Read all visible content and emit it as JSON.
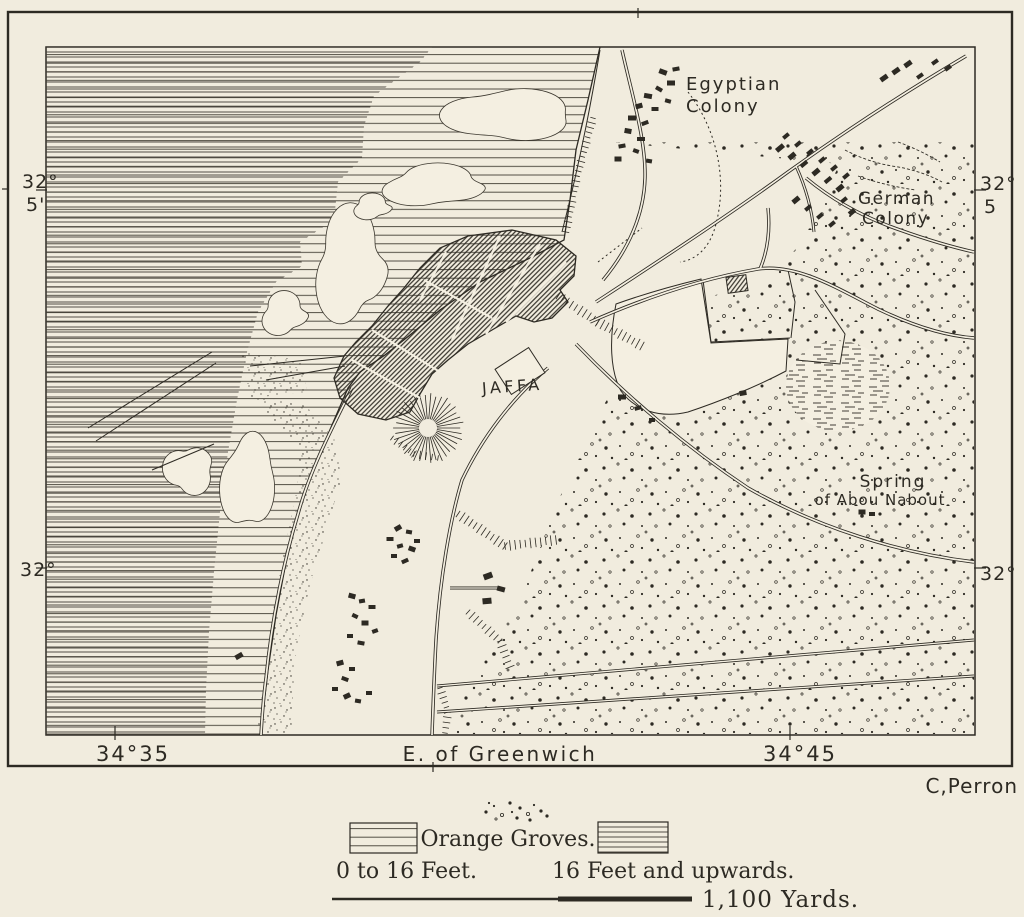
{
  "map_labels": {
    "jaffa": "JAFFA",
    "egyptian_colony": [
      "Egyptian",
      "Colony"
    ],
    "german_colony": [
      "German",
      "Colony"
    ],
    "spring": [
      "Spring",
      "of Abou Nabout"
    ]
  },
  "graticule": {
    "top_left": [
      "32°",
      "5'"
    ],
    "top_right": [
      "32°",
      "5"
    ],
    "bottom_left": "32°",
    "bottom_right": "32°",
    "lon_west": "34°35",
    "lon_center": "E. of Greenwich",
    "lon_east": "34°45"
  },
  "credit": "C,Perron",
  "legend": {
    "groves_label": "Orange Groves.",
    "shallow_label": "0 to 16 Feet.",
    "deep_label": "16 Feet and upwards.",
    "scale_label": "1,100 Yards."
  },
  "colors": {
    "paper": "#f1ecde",
    "paper_map": "#f4efe1",
    "ink": "#2d2a23"
  },
  "features": {
    "roads": [
      {
        "d": "M596,302 C648,268 722,220 788,172 C852,126 912,88 966,56"
      },
      {
        "d": "M806,178 C836,203 868,219 900,230 C928,240 952,247 974,252"
      },
      {
        "d": "M622,50 C632,95 646,140 645,178 C644,215 628,250 603,280"
      },
      {
        "d": "M590,322 C642,299 700,279 758,269 C798,263 840,290 880,310 C916,327 948,336 974,338"
      },
      {
        "d": "M760,269 C768,250 770,228 768,208"
      },
      {
        "d": "M576,344 C628,398 688,448 748,488 C818,528 900,553 974,562"
      },
      {
        "d": "M352,388 C332,428 310,470 298,514 C284,560 272,618 266,678 C263,700 262,718 261,735"
      },
      {
        "d": "M548,368 C512,398 482,438 462,480 C450,520 440,578 436,640 C434,678 433,708 432,735"
      },
      {
        "d": "M450,588 L499,588",
        "w": 3
      },
      {
        "d": "M437,686 L974,640",
        "w": 3
      },
      {
        "d": "M437,712 C610,700 800,688 974,676",
        "w": 3
      },
      {
        "d": "M796,166 C806,188 812,210 814,232",
        "w": 3
      }
    ],
    "thin_lines": [
      "M703,280 L711,342 L790,338",
      "M788,270 L795,302 L791,338",
      "M815,290 L845,334 L840,364 L796,360",
      "M600,50 C590,110 578,170 562,232",
      "M88,428 L212,352",
      "M96,441 L216,363",
      "M152,470 L214,444",
      "M345,356 L250,366",
      "M345,366 L266,380"
    ],
    "dashed_lines": [
      "M688,92 C716,128 728,178 716,224 C710,248 696,260 680,262",
      "M598,262 L642,228"
    ],
    "scribble_lines": [
      "M845,150 Q868,162 892,166 Q920,170 942,182",
      "M858,176 Q886,186 916,190",
      "M898,142 Q920,150 940,162"
    ],
    "buildings": [
      [
        663,
        72,
        8,
        5,
        20
      ],
      [
        676,
        69,
        7,
        4,
        -10
      ],
      [
        671,
        83,
        8,
        5,
        0
      ],
      [
        659,
        89,
        7,
        4,
        30
      ],
      [
        648,
        96,
        8,
        5,
        10
      ],
      [
        639,
        106,
        7,
        5,
        -15
      ],
      [
        655,
        109,
        7,
        4,
        0
      ],
      [
        668,
        101,
        6,
        4,
        15
      ],
      [
        632,
        118,
        8,
        5,
        0
      ],
      [
        645,
        123,
        7,
        4,
        -20
      ],
      [
        628,
        131,
        7,
        5,
        10
      ],
      [
        641,
        139,
        8,
        4,
        0
      ],
      [
        622,
        146,
        7,
        4,
        -10
      ],
      [
        636,
        151,
        6,
        4,
        20
      ],
      [
        618,
        159,
        7,
        5,
        0
      ],
      [
        649,
        161,
        6,
        4,
        10
      ],
      [
        884,
        78,
        8,
        5,
        -35
      ],
      [
        896,
        71,
        8,
        5,
        -35
      ],
      [
        908,
        64,
        8,
        5,
        -35
      ],
      [
        920,
        76,
        7,
        4,
        -35
      ],
      [
        935,
        62,
        7,
        4,
        -35
      ],
      [
        948,
        68,
        7,
        4,
        -35
      ],
      [
        780,
        148,
        9,
        5,
        -40
      ],
      [
        792,
        156,
        8,
        5,
        -40
      ],
      [
        804,
        164,
        8,
        4,
        -40
      ],
      [
        816,
        172,
        8,
        5,
        -40
      ],
      [
        828,
        180,
        8,
        4,
        -40
      ],
      [
        840,
        188,
        8,
        5,
        -40
      ],
      [
        786,
        136,
        7,
        4,
        -40
      ],
      [
        798,
        144,
        7,
        4,
        -40
      ],
      [
        810,
        152,
        7,
        4,
        -40
      ],
      [
        822,
        160,
        7,
        4,
        -40
      ],
      [
        834,
        168,
        7,
        4,
        -40
      ],
      [
        846,
        176,
        7,
        4,
        -40
      ],
      [
        796,
        200,
        8,
        5,
        -40
      ],
      [
        808,
        208,
        7,
        4,
        -40
      ],
      [
        820,
        216,
        7,
        4,
        -40
      ],
      [
        832,
        224,
        7,
        4,
        -40
      ],
      [
        844,
        200,
        7,
        4,
        -40
      ],
      [
        852,
        212,
        7,
        5,
        -40
      ],
      [
        398,
        528,
        7,
        5,
        -30
      ],
      [
        409,
        532,
        6,
        4,
        10
      ],
      [
        390,
        539,
        7,
        4,
        0
      ],
      [
        400,
        546,
        6,
        4,
        -15
      ],
      [
        412,
        549,
        7,
        5,
        20
      ],
      [
        394,
        556,
        6,
        4,
        0
      ],
      [
        405,
        561,
        7,
        4,
        -25
      ],
      [
        417,
        541,
        6,
        4,
        0
      ],
      [
        352,
        596,
        7,
        5,
        15
      ],
      [
        362,
        601,
        6,
        4,
        -10
      ],
      [
        372,
        607,
        7,
        4,
        0
      ],
      [
        355,
        616,
        6,
        4,
        25
      ],
      [
        365,
        623,
        7,
        5,
        0
      ],
      [
        375,
        631,
        6,
        4,
        -20
      ],
      [
        350,
        636,
        6,
        4,
        0
      ],
      [
        361,
        643,
        7,
        4,
        10
      ],
      [
        340,
        663,
        7,
        5,
        -15
      ],
      [
        352,
        669,
        6,
        4,
        0
      ],
      [
        345,
        679,
        7,
        4,
        20
      ],
      [
        335,
        689,
        6,
        4,
        0
      ],
      [
        347,
        696,
        7,
        5,
        -25
      ],
      [
        358,
        701,
        6,
        4,
        10
      ],
      [
        369,
        693,
        6,
        4,
        0
      ],
      [
        488,
        576,
        9,
        6,
        -20
      ],
      [
        501,
        589,
        8,
        5,
        15
      ],
      [
        487,
        601,
        9,
        6,
        -5
      ],
      [
        622,
        397,
        8,
        5,
        0
      ],
      [
        638,
        408,
        7,
        4,
        -15
      ],
      [
        652,
        420,
        6,
        4,
        0
      ],
      [
        862,
        512,
        7,
        5,
        0
      ],
      [
        872,
        514,
        6,
        4,
        0
      ],
      [
        239,
        656,
        8,
        5,
        -30
      ],
      [
        743,
        393,
        7,
        5,
        -10
      ]
    ],
    "bursts": [
      {
        "x": 428,
        "y": 428,
        "r1": 9,
        "r2": 34,
        "n": 38
      }
    ],
    "ticklines": [
      {
        "pts": [
          [
            593,
            118
          ],
          [
            577,
            176
          ],
          [
            566,
            232
          ]
        ],
        "len": 7
      },
      {
        "pts": [
          [
            558,
            296
          ],
          [
            598,
            322
          ],
          [
            642,
            346
          ]
        ],
        "len": 9
      },
      {
        "pts": [
          [
            458,
            514
          ],
          [
            505,
            546
          ],
          [
            556,
            540
          ]
        ],
        "len": 9
      },
      {
        "pts": [
          [
            468,
            612
          ],
          [
            500,
            641
          ],
          [
            510,
            667
          ]
        ],
        "len": 8
      },
      {
        "pts": [
          [
            440,
            688
          ],
          [
            448,
            712
          ],
          [
            445,
            733
          ]
        ],
        "len": 7
      },
      {
        "pts": [
          [
            392,
            438
          ],
          [
            414,
            454
          ],
          [
            438,
            458
          ]
        ],
        "len": 7
      }
    ],
    "veg_blobs": [
      {
        "x": 505,
        "y": 115,
        "rx": 56,
        "ry": 26
      },
      {
        "x": 432,
        "y": 186,
        "rx": 46,
        "ry": 20
      },
      {
        "x": 350,
        "y": 266,
        "rx": 34,
        "ry": 54
      },
      {
        "x": 284,
        "y": 314,
        "rx": 22,
        "ry": 20
      },
      {
        "x": 247,
        "y": 482,
        "rx": 24,
        "ry": 46
      },
      {
        "x": 188,
        "y": 470,
        "rx": 22,
        "ry": 24
      },
      {
        "x": 372,
        "y": 207,
        "rx": 18,
        "ry": 12
      }
    ],
    "legend_dots": [
      [
        486,
        812
      ],
      [
        494,
        806
      ],
      [
        502,
        815
      ],
      [
        510,
        803
      ],
      [
        512,
        812
      ],
      [
        520,
        808
      ],
      [
        528,
        814
      ],
      [
        534,
        805
      ],
      [
        541,
        811
      ],
      [
        547,
        816
      ],
      [
        496,
        819
      ],
      [
        517,
        818
      ],
      [
        530,
        820
      ],
      [
        489,
        803
      ]
    ]
  }
}
